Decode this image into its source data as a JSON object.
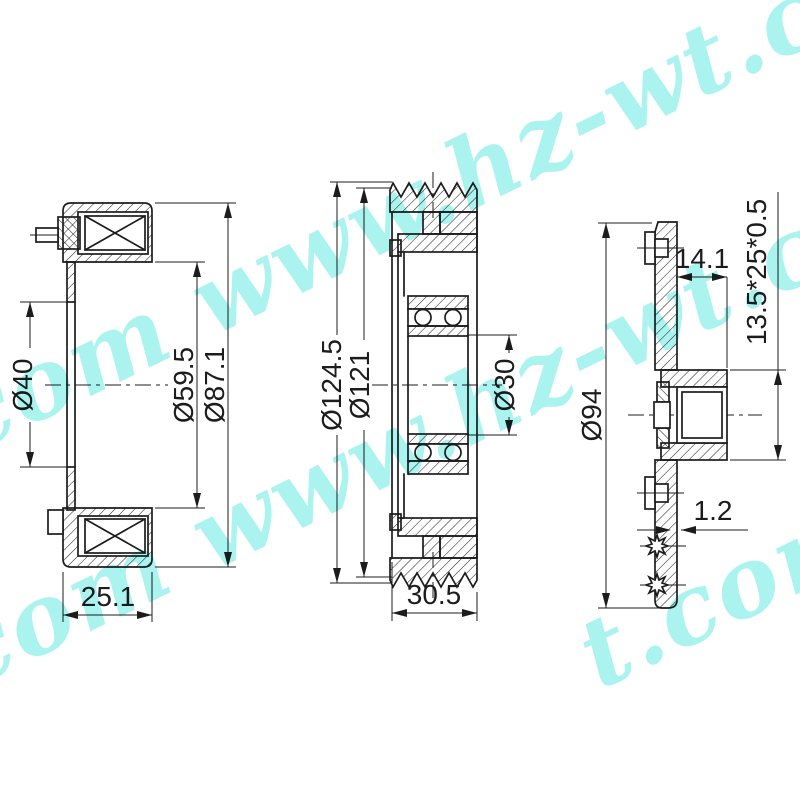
{
  "page": {
    "background": "#ffffff",
    "kind": "technical-drawing",
    "line_color": "#1c1c1c"
  },
  "drawing": {
    "views": {
      "left": {
        "title": "field-coil-section",
        "dims": {
          "inner_bore": "Ø40",
          "coil_inner_dia": "Ø59.5",
          "coil_outer_dia": "Ø87.1",
          "depth": "25.1"
        }
      },
      "middle": {
        "title": "pulley-section",
        "dims": {
          "outer_dia": "Ø124.5",
          "groove_dia": "Ø121",
          "bearing_bore_dia": "Ø30",
          "width": "30.5"
        }
      },
      "right": {
        "title": "clutch-hub-section",
        "dims": {
          "outer_dia": "Ø94",
          "hub_depth": "14.1",
          "spline_spec": "13.5*25*0.5",
          "plate_thickness": "1.2"
        }
      }
    }
  },
  "watermark": {
    "site": "www.hz-wt.com",
    "color": "#58e8df",
    "instances": [
      {
        "text": "com www.hz-wt.com"
      },
      {
        "text": "com www.hz-wt.com"
      },
      {
        "text": "t.com"
      }
    ]
  }
}
